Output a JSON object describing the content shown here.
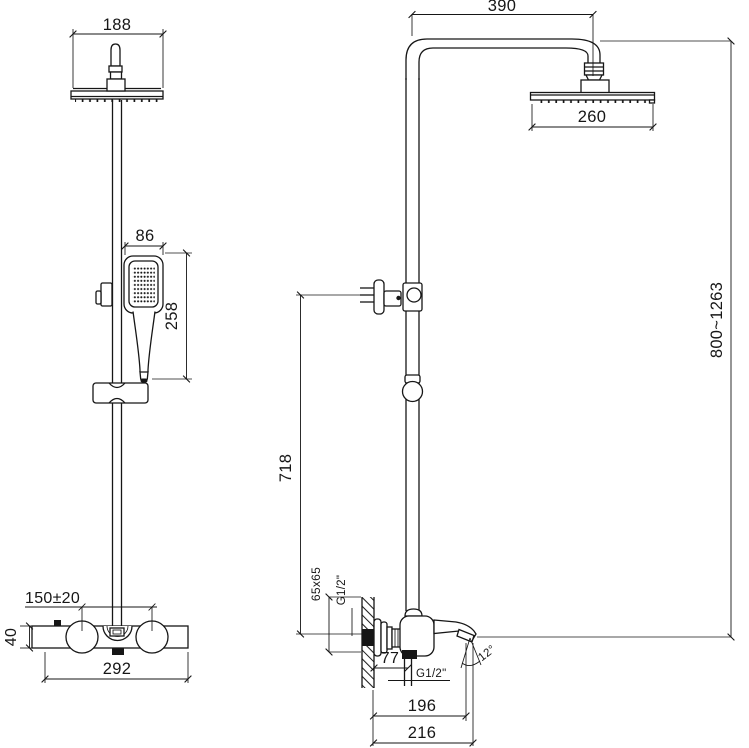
{
  "drawing": {
    "front": {
      "overhead_width": "188",
      "handset_width": "86",
      "handset_length": "258",
      "handle_spacing": "150±20",
      "mixer_height": "40",
      "mixer_width": "292"
    },
    "side": {
      "arm_reach": "390",
      "overhead_diameter": "260",
      "height_range": "800~1263",
      "holder_height": "718",
      "wall_plate_size": "65x65",
      "inlet_thread": "G1/2\"",
      "wall_clearance": "77",
      "outlet_thread": "G1/2\"",
      "spout_angle": "12°",
      "spout_reach": "196",
      "spout_overall": "216"
    }
  }
}
